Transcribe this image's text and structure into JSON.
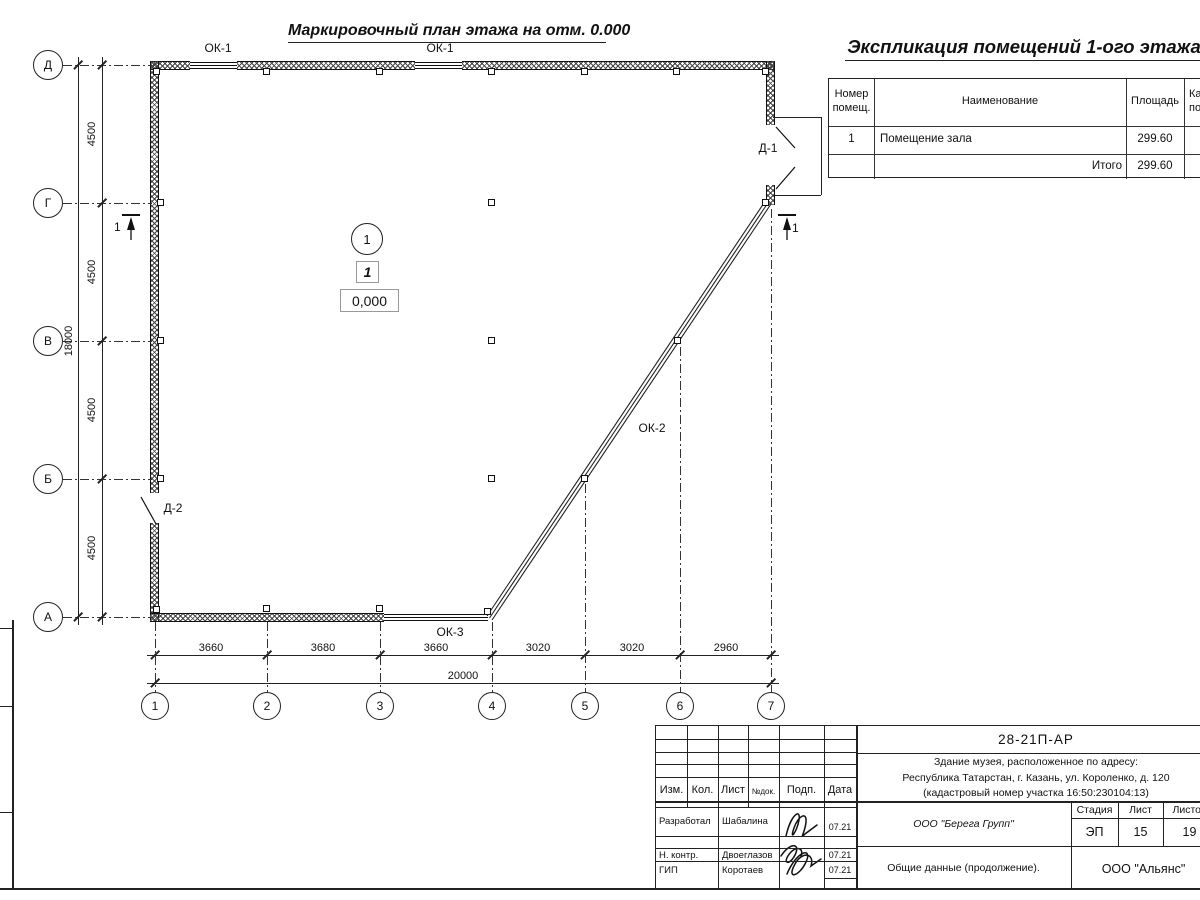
{
  "plan": {
    "title": "Маркировочный план этажа на отм. 0.000",
    "axes_rows": [
      "Д",
      "Г",
      "В",
      "Б",
      "А"
    ],
    "axes_cols": [
      "1",
      "2",
      "3",
      "4",
      "5",
      "6",
      "7"
    ],
    "dims_left": [
      "4500",
      "4500",
      "4500",
      "4500"
    ],
    "dim_left_total": "18000",
    "dims_bottom": [
      "3660",
      "3680",
      "3660",
      "3020",
      "3020",
      "2960"
    ],
    "dim_bottom_total": "20000",
    "window_labels": {
      "ok1a": "ОК-1",
      "ok1b": "ОК-1",
      "ok2": "ОК-2",
      "ok3": "ОК-3"
    },
    "door_labels": {
      "d1": "Д-1",
      "d2": "Д-2"
    },
    "section_marks": {
      "left": "1",
      "right": "1"
    },
    "room": {
      "number_circle": "1",
      "number_box": "1",
      "elevation": "0,000"
    }
  },
  "explication": {
    "title": "Экспликация помещений 1-ого этажа",
    "headers": {
      "num_l1": "Номер",
      "num_l2": "помещ.",
      "name": "Наименование",
      "area": "Площадь",
      "cat_l1": "Ка",
      "cat_l2": "по"
    },
    "rows": [
      {
        "num": "1",
        "name": "Помещение зала",
        "area": "299.60"
      }
    ],
    "total": {
      "label": "Итого",
      "area": "299.60"
    }
  },
  "titleblock": {
    "doc_number": "28-21П-АР",
    "address_l1": "Здание музея, расположенное по адресу:",
    "address_l2": "Республика Татарстан, г. Казань, ул. Короленко, д. 120",
    "address_l3": "(кадастровый номер участка 16:50:230104:13)",
    "org": "ООО \"Берега Групп\"",
    "doc_title": "Общие данные (продолжение).",
    "contractor": "ООО \"Альянс\"",
    "stage": {
      "label": "Стадия",
      "value": "ЭП"
    },
    "sheet": {
      "label": "Лист",
      "value": "15"
    },
    "sheets": {
      "label": "Листов",
      "value": "19"
    },
    "rev_headers": [
      "Изм.",
      "Кол.",
      "Лист",
      "№док.",
      "Подп.",
      "Дата"
    ],
    "signers": [
      {
        "role": "Разработал",
        "name": "Шабалина",
        "date": "07.21"
      },
      {
        "role": "Н. контр.",
        "name": "Двоеглазов",
        "date": "07.21"
      },
      {
        "role": "ГИП",
        "name": "Коротаев",
        "date": "07.21"
      }
    ]
  }
}
